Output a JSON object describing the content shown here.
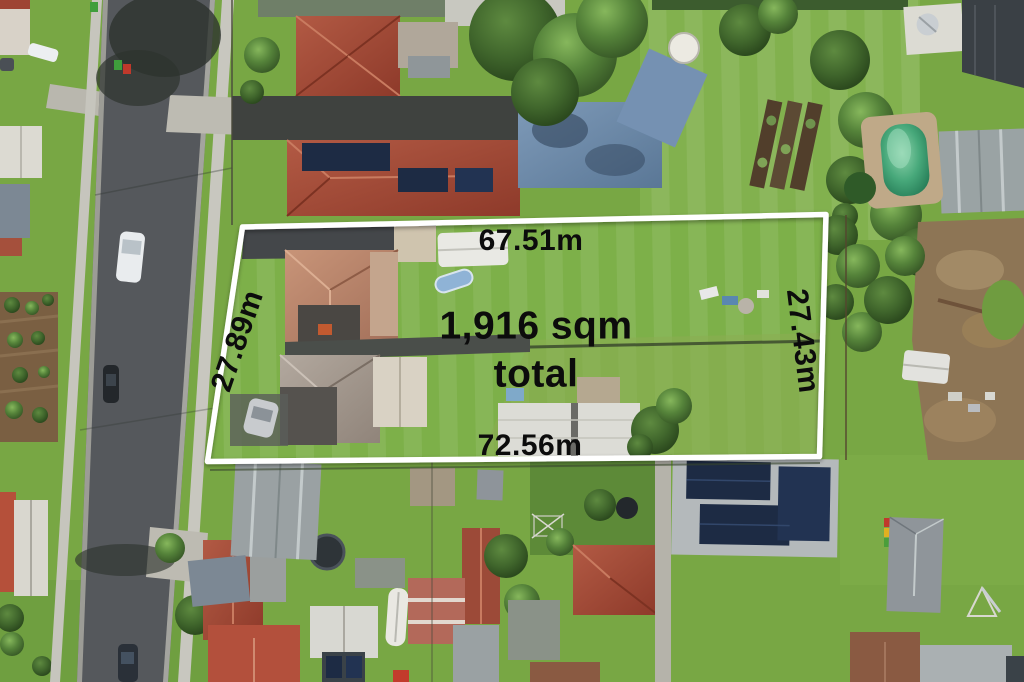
{
  "overlay": {
    "dimensions": {
      "top": "67.51m",
      "bottom": "72.56m",
      "left": "27.89m",
      "right": "27.43m"
    },
    "area": {
      "line1": "1,916 sqm",
      "line2": "total"
    },
    "border_color": "#ffffff",
    "label_color": "#0c0c0c"
  },
  "scene": {
    "palette": {
      "grass": "#7cab46",
      "road_asphalt": "#53565a",
      "roof_terracotta": "#a04a36",
      "roof_salmon": "#bb8a70",
      "roof_gray": "#9aa1a3",
      "solar_panel": "#1d2b44",
      "pool_water": "#2f8f6a",
      "dirt": "#8d7555",
      "concrete": "#c6c5bd",
      "tree_dark": "#3c6328"
    }
  }
}
